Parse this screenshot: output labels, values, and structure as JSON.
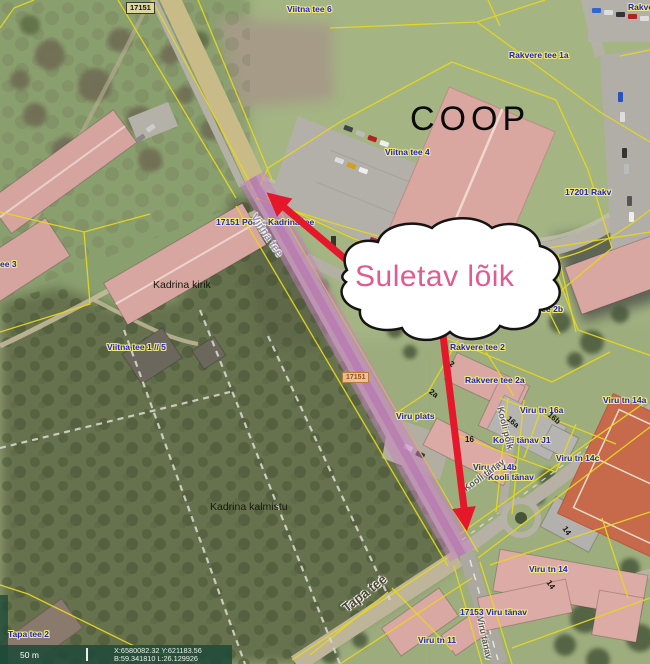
{
  "annotation": {
    "cloud_text": "Suletav lõik"
  },
  "map": {
    "coop_sign": "COOP",
    "road_plate_top": "17151",
    "road_plate_mid": "17151"
  },
  "scalebar": {
    "distance": "50 m",
    "coord_line1": "X:6580082.32 Y:621183.56",
    "coord_line2": "B:59.341810 L:26.129926"
  },
  "colors": {
    "label_blue": "#2323cc",
    "halo_yellow": "#efe97c",
    "cloud_pink": "#e25a92",
    "arrow_red": "#e5182b",
    "closure_pink": "#c97fc5",
    "closure_pink_dark": "#b257ab",
    "cadastral_yellow": "#e6d71f"
  },
  "map_labels": [
    {
      "text": "Viitna tee 6",
      "x": 287,
      "y": 5,
      "cls": "addr"
    },
    {
      "text": "Rakve",
      "x": 628,
      "y": 3,
      "cls": "addr"
    },
    {
      "text": "Rakvere tee 1a",
      "x": 509,
      "y": 51,
      "cls": "addr"
    },
    {
      "text": "Viitna tee 4",
      "x": 385,
      "y": 148,
      "cls": "addr"
    },
    {
      "text": "17201 Rakv",
      "x": 565,
      "y": 188,
      "cls": "addr"
    },
    {
      "text": "17151 Põhja-Kadrina tee",
      "x": 216,
      "y": 218,
      "cls": "addr"
    },
    {
      "text": "Viitna tee",
      "x": 258,
      "y": 212,
      "cls": "street",
      "rot": 56
    },
    {
      "text": "Kadrina kirik",
      "x": 153,
      "y": 280,
      "cls": "place"
    },
    {
      "text": "ee 3",
      "x": 0,
      "y": 260,
      "cls": "addr"
    },
    {
      "text": "Viitna tee 1 // 5",
      "x": 107,
      "y": 343,
      "cls": "addr"
    },
    {
      "text": "Rakvere tee 2b",
      "x": 503,
      "y": 305,
      "cls": "addr"
    },
    {
      "text": "Rakvere tee 2",
      "x": 450,
      "y": 343,
      "cls": "addr"
    },
    {
      "text": "Rakvere tee 2a",
      "x": 465,
      "y": 376,
      "cls": "addr"
    },
    {
      "text": "Viru tn 16a",
      "x": 520,
      "y": 406,
      "cls": "addr"
    },
    {
      "text": "Viru tn 14a",
      "x": 603,
      "y": 396,
      "cls": "addr"
    },
    {
      "text": "Viru plats",
      "x": 396,
      "y": 412,
      "cls": "addr"
    },
    {
      "text": "Kooli tänav J1",
      "x": 493,
      "y": 436,
      "cls": "addr"
    },
    {
      "text": "Viru tn 14b",
      "x": 473,
      "y": 463,
      "cls": "addr"
    },
    {
      "text": "Kooli tänav",
      "x": 488,
      "y": 473,
      "cls": "addr"
    },
    {
      "text": "Viru tn 14c",
      "x": 556,
      "y": 454,
      "cls": "addr"
    },
    {
      "text": "Viru tn 14",
      "x": 529,
      "y": 565,
      "cls": "addr"
    },
    {
      "text": "17153 Viru tänav",
      "x": 460,
      "y": 608,
      "cls": "addr"
    },
    {
      "text": "Viru tn 11",
      "x": 418,
      "y": 636,
      "cls": "addr"
    },
    {
      "text": "Tapa tee 2",
      "x": 8,
      "y": 630,
      "cls": "addr"
    },
    {
      "text": "Kadrina kalmistu",
      "x": 210,
      "y": 502,
      "cls": "place"
    },
    {
      "text": "Tapa tee",
      "x": 340,
      "y": 604,
      "cls": "street-dark",
      "rot": -38
    },
    {
      "text": "Kooli põik",
      "x": 504,
      "y": 406,
      "cls": "street-sm",
      "rot": 76
    },
    {
      "text": "Kooli tänav",
      "x": 462,
      "y": 486,
      "cls": "street-sm",
      "rot": -36
    },
    {
      "text": "Viru tänav",
      "x": 484,
      "y": 616,
      "cls": "street-sm",
      "rot": 78
    },
    {
      "text": "16",
      "x": 465,
      "y": 436,
      "cls": "parcel"
    },
    {
      "text": "14",
      "x": 567,
      "y": 525,
      "cls": "parcel",
      "rot": 55
    },
    {
      "text": "14",
      "x": 551,
      "y": 579,
      "cls": "parcel",
      "rot": 55
    },
    {
      "text": "16a",
      "x": 510,
      "y": 415,
      "cls": "parcel",
      "rot": 40
    },
    {
      "text": "16b",
      "x": 551,
      "y": 411,
      "cls": "parcel",
      "rot": 40
    },
    {
      "text": "2",
      "x": 452,
      "y": 360,
      "cls": "parcel",
      "rot": 35
    },
    {
      "text": "2a",
      "x": 432,
      "y": 388,
      "cls": "parcel",
      "rot": 35
    }
  ]
}
